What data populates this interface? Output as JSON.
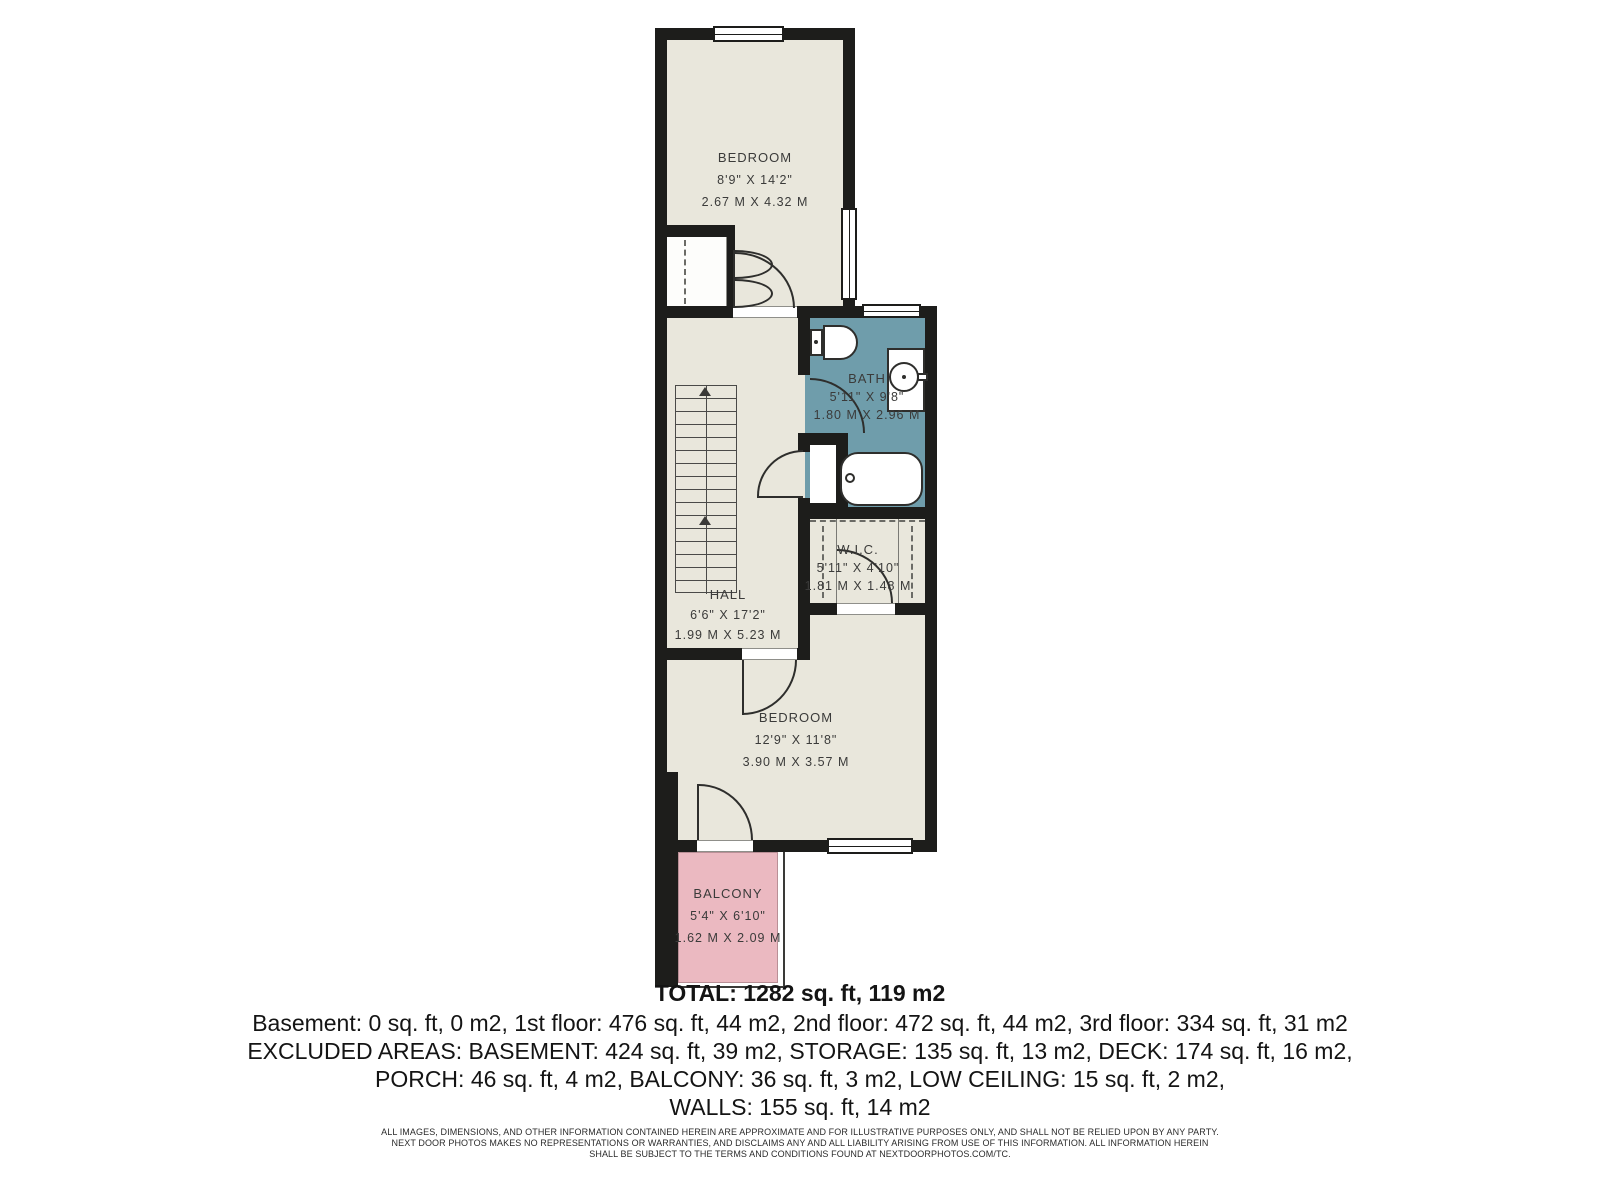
{
  "rooms": [
    {
      "name": "BEDROOM",
      "imperial": "8'9\" X 14'2\"",
      "metric": "2.67 M X 4.32 M"
    },
    {
      "name": "BATH",
      "imperial": "5'11\" X 9'8\"",
      "metric": "1.80 M X 2.96 M"
    },
    {
      "name": "W.I.C.",
      "imperial": "5'11\" X 4'10\"",
      "metric": "1.81 M X 1.48 M"
    },
    {
      "name": "HALL",
      "imperial": "6'6\" X 17'2\"",
      "metric": "1.99 M X 5.23 M"
    },
    {
      "name": "BEDROOM",
      "imperial": "12'9\" X 11'8\"",
      "metric": "3.90 M X 3.57 M"
    },
    {
      "name": "BALCONY",
      "imperial": "5'4\" X 6'10\"",
      "metric": "1.62 M X 2.09 M"
    }
  ],
  "summary": {
    "total": "TOTAL: 1282 sq. ft, 119 m2",
    "floors": "Basement: 0 sq. ft, 0 m2, 1st floor: 476 sq. ft, 44 m2, 2nd floor: 472 sq. ft, 44 m2, 3rd floor: 334 sq. ft, 31 m2",
    "excluded1": "EXCLUDED AREAS: BASEMENT: 424 sq. ft, 39 m2, STORAGE: 135 sq. ft, 13 m2, DECK: 174 sq. ft, 16 m2,",
    "excluded2": "PORCH: 46 sq. ft, 4 m2, BALCONY: 36 sq. ft, 3 m2, LOW CEILING: 15 sq. ft, 2 m2,",
    "walls": "WALLS: 155 sq. ft, 14 m2"
  },
  "disclaimer": {
    "line1": "ALL IMAGES, DIMENSIONS, AND OTHER INFORMATION CONTAINED HEREIN ARE APPROXIMATE AND FOR ILLUSTRATIVE PURPOSES ONLY, AND SHALL NOT BE RELIED UPON BY ANY PARTY.",
    "line2": "NEXT DOOR PHOTOS MAKES NO REPRESENTATIONS OR WARRANTIES, AND DISCLAIMS ANY AND ALL LIABILITY ARISING FROM USE OF THIS INFORMATION. ALL INFORMATION HEREIN",
    "line3": "SHALL BE SUBJECT TO THE TERMS AND CONDITIONS FOUND AT NEXTDOORPHOTOS.COM/TC."
  },
  "colors": {
    "wall": "#1d1d1b",
    "floor": "#e9e7dc",
    "bath_floor": "#6f9dab",
    "balcony_floor": "#ebb9c1",
    "label_text": "#3b3b3a"
  }
}
